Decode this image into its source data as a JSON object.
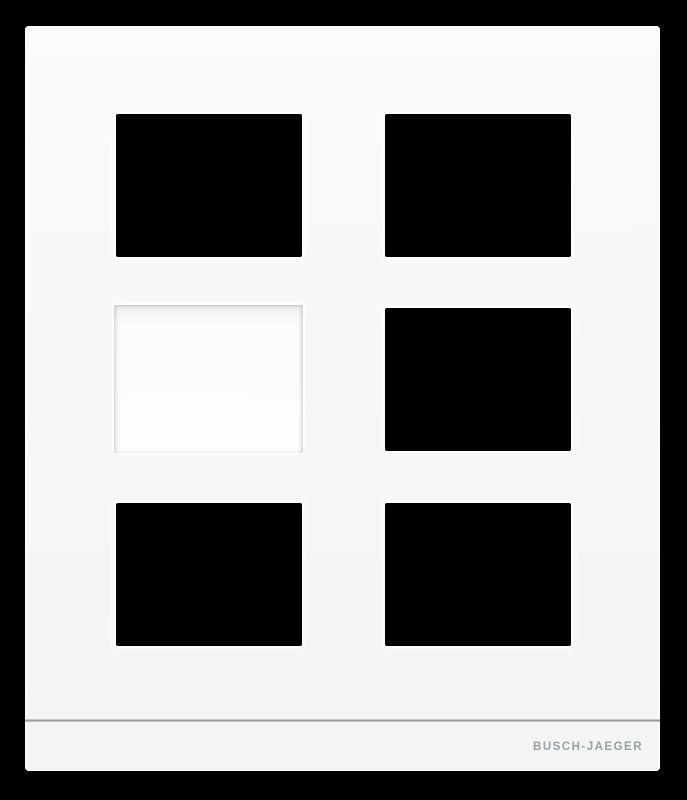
{
  "product": {
    "brand_label": "BUSCH-JAEGER",
    "colors": {
      "background": "#000000",
      "frame": "#f5f6f6",
      "opening": "#000000",
      "blank_cover": "#fcfdfd",
      "groove_line": "#8d9293",
      "brand_text": "#9aa0a5"
    },
    "slots": [
      {
        "position": "top-left",
        "kind": "module-opening"
      },
      {
        "position": "top-right",
        "kind": "module-opening"
      },
      {
        "position": "middle-left",
        "kind": "blank-cover"
      },
      {
        "position": "middle-right",
        "kind": "module-opening"
      },
      {
        "position": "bottom-left",
        "kind": "module-opening"
      },
      {
        "position": "bottom-right",
        "kind": "module-opening"
      }
    ]
  }
}
